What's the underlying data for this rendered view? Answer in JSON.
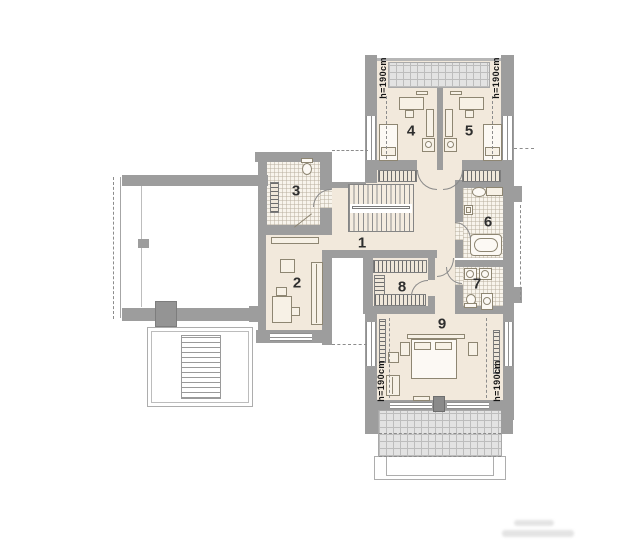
{
  "rooms": [
    {
      "number": "1"
    },
    {
      "number": "2"
    },
    {
      "number": "3"
    },
    {
      "number": "4"
    },
    {
      "number": "5"
    },
    {
      "number": "6"
    },
    {
      "number": "7"
    },
    {
      "number": "8"
    },
    {
      "number": "9"
    }
  ],
  "height_labels": [
    "h=190cm",
    "h=190cm",
    "h=190cm",
    "h=190cm"
  ],
  "colors": {
    "wall": "#9d9d9d",
    "floor": "#f2e9dc",
    "tile_floor": "#f8f4ec",
    "terrace_grid": "#e3e3e3",
    "label_text": "#2e2e2e"
  }
}
